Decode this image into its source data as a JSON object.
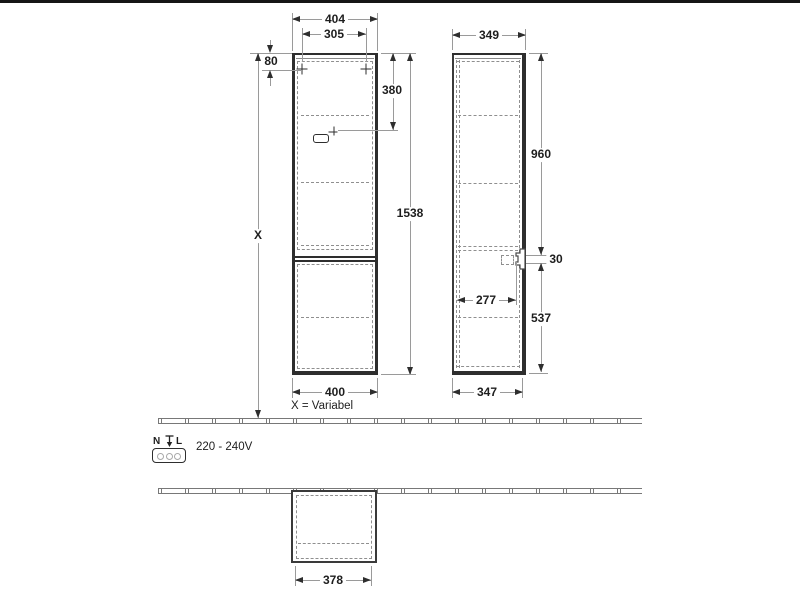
{
  "front": {
    "dim_width_top": "404",
    "dim_mount_spacing": "305",
    "dim_mount_offset": "80",
    "dim_socket_from_top": "380",
    "dim_total_height": "1538",
    "dim_height_variable": "X",
    "dim_width_bottom": "400",
    "note_variable": "X = Variabel"
  },
  "side": {
    "dim_depth_top": "349",
    "dim_upper_section": "960",
    "dim_socket_cutout": "30",
    "dim_socket_depth": "277",
    "dim_lower_section": "537",
    "dim_depth_bottom": "347"
  },
  "plan": {
    "dim_width": "378"
  },
  "electrical": {
    "terminal_n": "N",
    "terminal_l": "L",
    "voltage_range": "220 - 240V"
  },
  "icons": {
    "mounting_point": "plus-cross",
    "socket_outlet": "rounded-rect-outlet",
    "plug_connector": "plug-profile",
    "earth": "earth-ground-symbol"
  },
  "colors": {
    "structure": "#2e2e2e",
    "dimension_lines": "#9a9a9a",
    "dashed_lines": "#8f8f8f",
    "text": "#1e1e1e"
  }
}
